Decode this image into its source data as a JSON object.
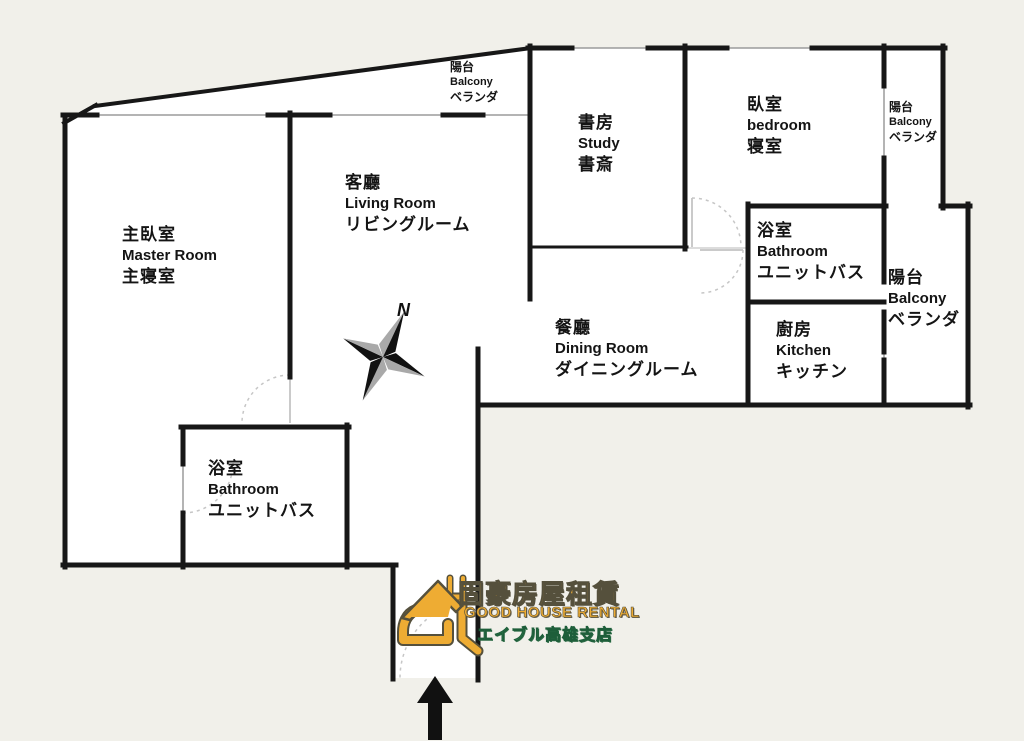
{
  "title": "apartment floor plan",
  "colors": {
    "background": "#f1f0ea",
    "floor": "#ffffff",
    "wall": "#171717",
    "window_line": "#9b9b9b",
    "door_line": "#b9b9b9",
    "logo_orange": "#eeac33",
    "logo_outline": "#55503c",
    "logo_green": "#3da169",
    "compass_black": "#111111",
    "compass_gray": "#a9a9a9",
    "arrow": "#111111"
  },
  "rooms": {
    "master": {
      "zh": "主臥室",
      "en": "Master Room",
      "ja": "主寝室"
    },
    "living": {
      "zh": "客廳",
      "en": "Living Room",
      "ja": "リビングルーム"
    },
    "study": {
      "zh": "書房",
      "en": "Study",
      "ja": "書斎"
    },
    "bedroom": {
      "zh": "臥室",
      "en": "bedroom",
      "ja": "寝室"
    },
    "dining": {
      "zh": "餐廳",
      "en": "Dining Room",
      "ja": "ダイニングルーム"
    },
    "kitchen": {
      "zh": "廚房",
      "en": "Kitchen",
      "ja": "キッチン"
    },
    "bathroom_upper": {
      "zh": "浴室",
      "en": "Bathroom",
      "ja": "ユニットバス"
    },
    "bathroom_lower": {
      "zh": "浴室",
      "en": "Bathroom",
      "ja": "ユニットバス"
    },
    "balcony_top": {
      "zh": "陽台",
      "en": "Balcony",
      "ja": "ベランダ"
    },
    "balcony_right_upper": {
      "zh": "陽台",
      "en": "Balcony",
      "ja": "ベランダ"
    },
    "balcony_right_lower": {
      "zh": "陽台",
      "en": "Balcony",
      "ja": "ベランダ"
    }
  },
  "compass": {
    "label": "N"
  },
  "logo": {
    "zh": "固豪房屋租賃",
    "en": "GOOD HOUSE RENTAL",
    "ja": "エイブル高雄支店"
  }
}
